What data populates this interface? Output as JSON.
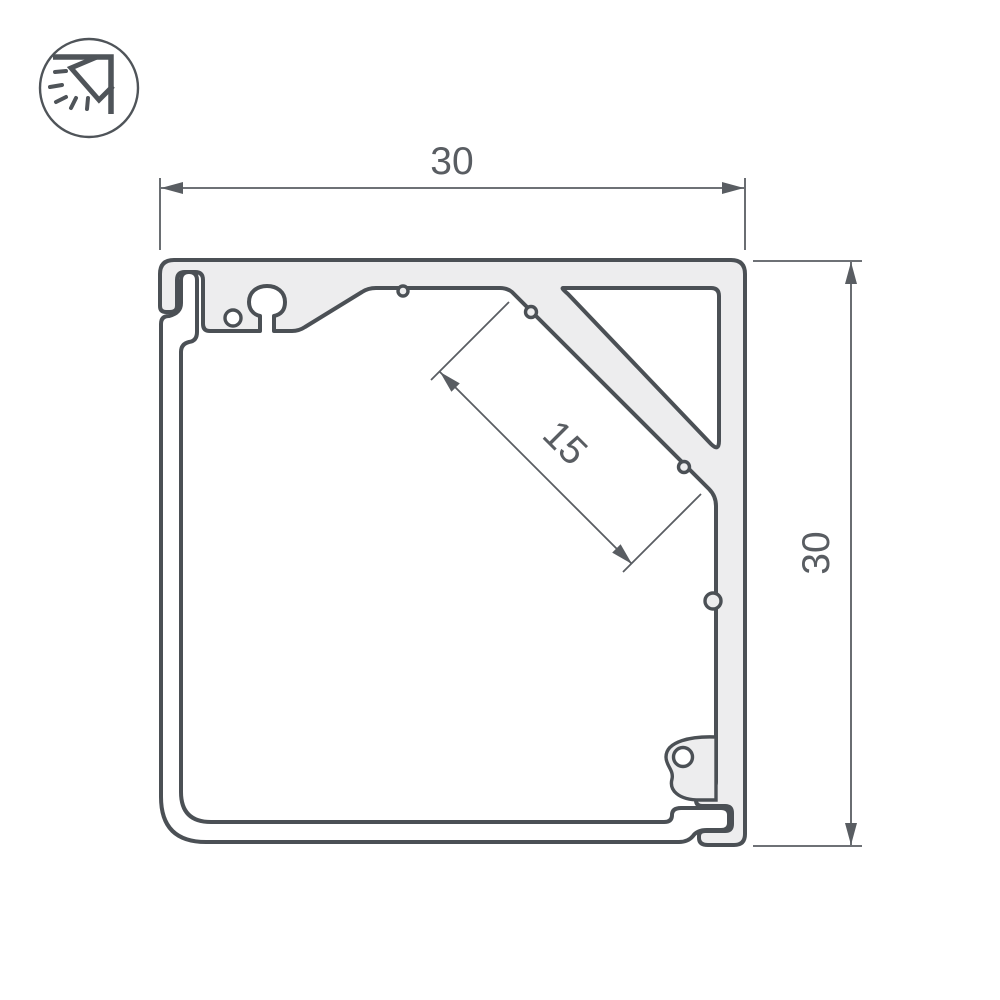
{
  "drawing": {
    "type": "technical-cross-section",
    "dimensions": {
      "width": {
        "label": "30"
      },
      "height": {
        "label": "30"
      },
      "led_surface": {
        "label": "15"
      }
    },
    "icon": {
      "name": "corner-mounted-light"
    },
    "colors": {
      "background": "#ffffff",
      "outline": "#4b5055",
      "dimension": "#595d62",
      "hatch": "#767c82",
      "metal_fill": "#ededee",
      "cover_fill": "#ffffff"
    }
  }
}
